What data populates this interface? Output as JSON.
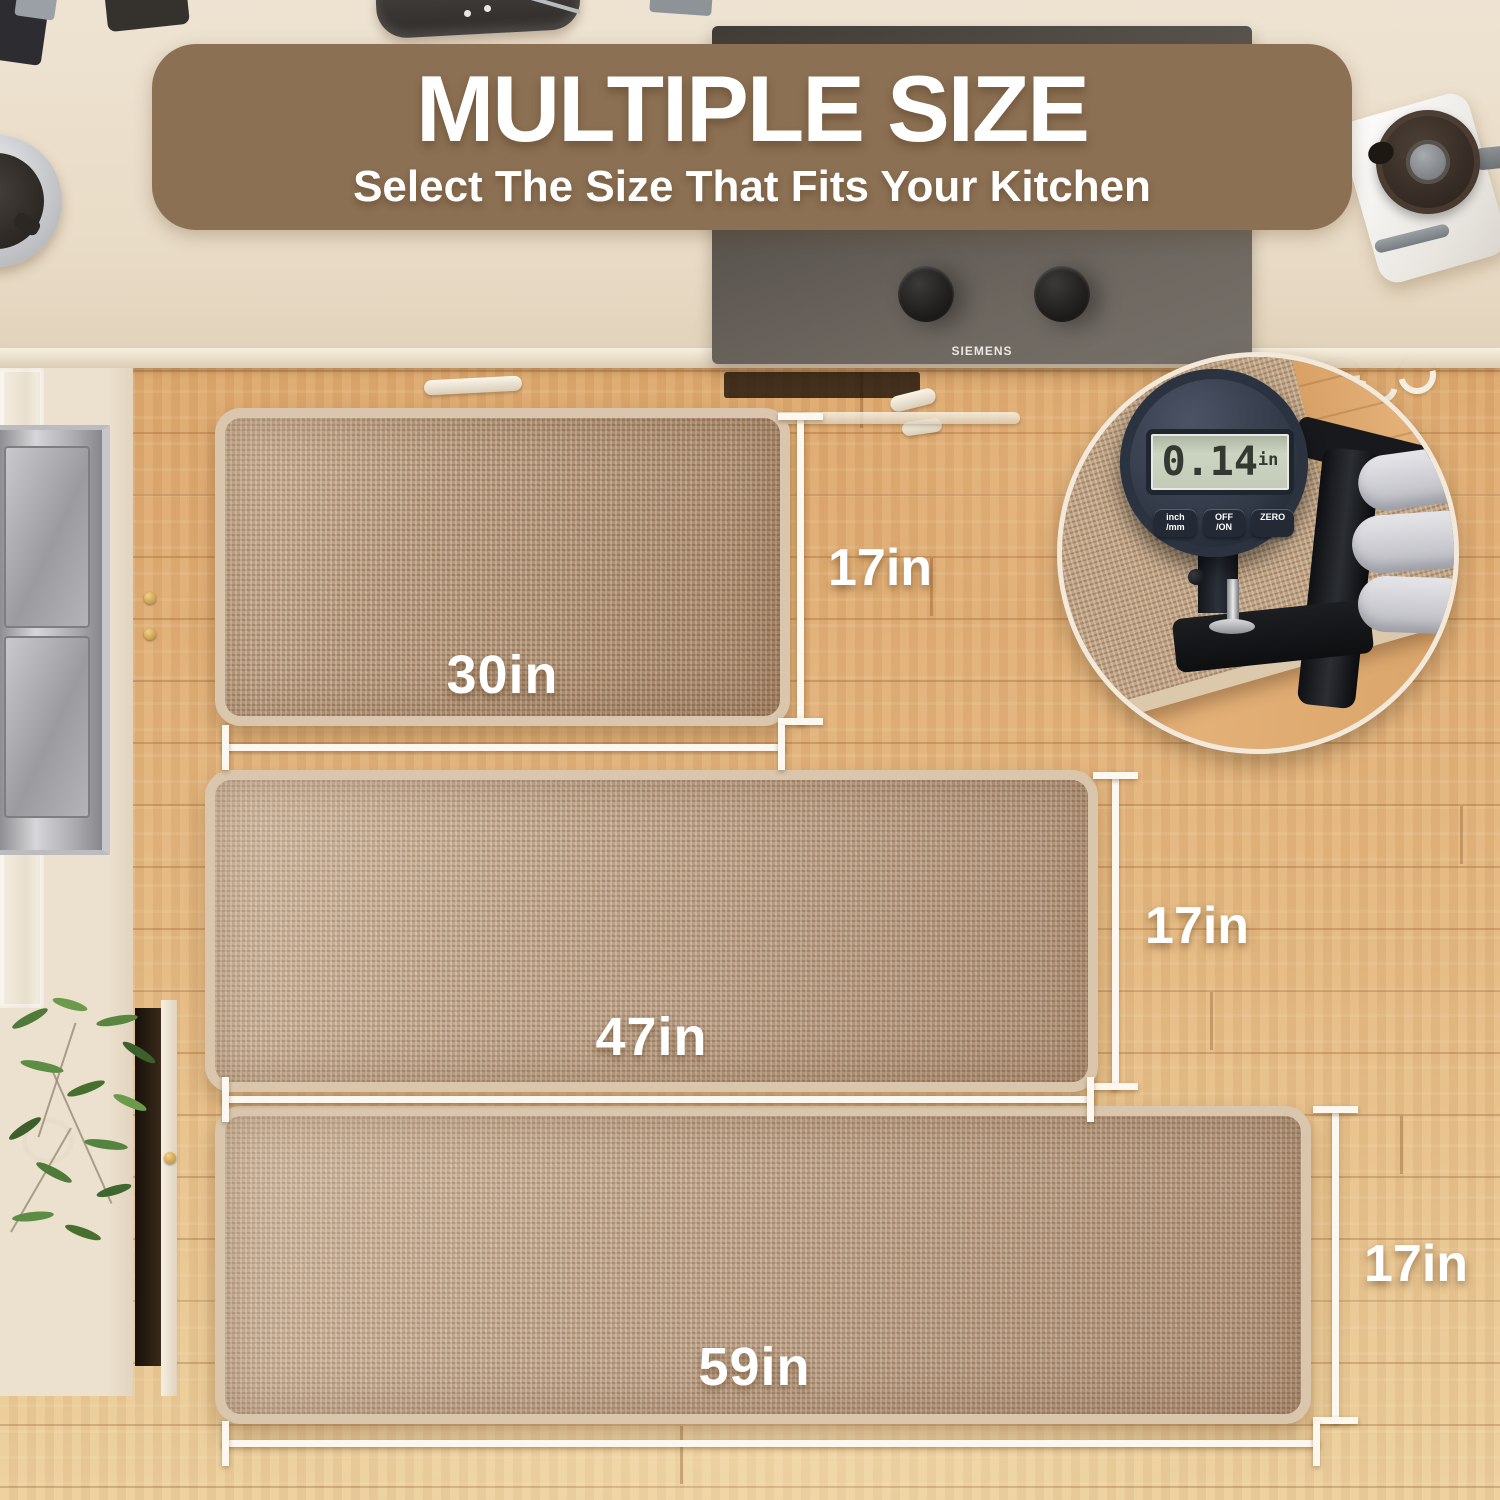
{
  "banner": {
    "title": "MULTIPLE SIZE",
    "subtitle": "Select The Size That Fits Your Kitchen"
  },
  "mats": [
    {
      "width_label": "30in",
      "height_label": "17in"
    },
    {
      "width_label": "47in",
      "height_label": "17in"
    },
    {
      "width_label": "59in",
      "height_label": "17in"
    }
  ],
  "thickness_gauge": {
    "reading": "0.14",
    "unit": "in",
    "buttons": [
      {
        "line1": "inch",
        "line2": "/mm"
      },
      {
        "line1": "OFF",
        "line2": "/ON"
      },
      {
        "line1": "ZERO",
        "line2": ""
      }
    ]
  },
  "cooktop": {
    "brand": "SIEMENS"
  },
  "colors": {
    "banner_bg": "#8c7053",
    "mat_fill": "#b5977a",
    "mat_border": "#d9c6ad",
    "floor_base": "#e0ab70",
    "dimension_line": "#fcf8ef",
    "lcd_bg": "#c8d0bd"
  }
}
